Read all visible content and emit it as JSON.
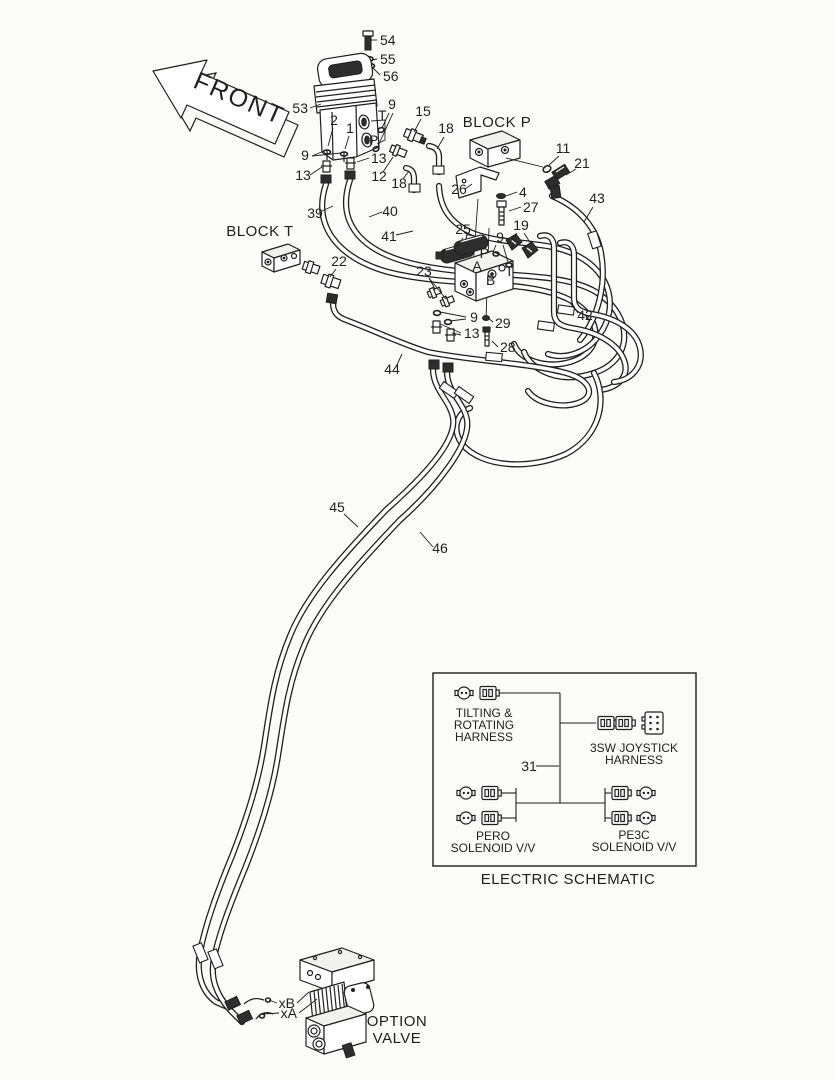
{
  "colors": {
    "ink": "#1f1f1f",
    "background": "#fbfbf9",
    "dark_fill": "#2e2e2e"
  },
  "front_arrow": {
    "label": "FRONT"
  },
  "labels": {
    "block_p": "BLOCK P",
    "block_t": "BLOCK T"
  },
  "option_valve": {
    "title_line1": "OPTION",
    "title_line2": "VALVE"
  },
  "electric_schematic": {
    "title": "ELECTRIC SCHEMATIC",
    "tilting_harness": [
      "TILTING &",
      "ROTATING",
      "HARNESS"
    ],
    "joystick_harness": [
      "3SW JOYSTICK",
      "HARNESS"
    ],
    "pero": [
      "PERO",
      "SOLENOID V/V"
    ],
    "pe3c": [
      "PE3C",
      "SOLENOID V/V"
    ],
    "connectors": [
      {
        "type": "round",
        "x": 464,
        "y": 693
      },
      {
        "type": "plug",
        "x": 488,
        "y": 693
      },
      {
        "type": "plug",
        "x": 606,
        "y": 723
      },
      {
        "type": "plug",
        "x": 624,
        "y": 723
      },
      {
        "type": "plug6",
        "x": 654,
        "y": 723
      },
      {
        "type": "round",
        "x": 466,
        "y": 793
      },
      {
        "type": "plug",
        "x": 490,
        "y": 793
      },
      {
        "type": "round",
        "x": 466,
        "y": 818
      },
      {
        "type": "plug",
        "x": 490,
        "y": 818
      },
      {
        "type": "plug",
        "x": 620,
        "y": 793
      },
      {
        "type": "round",
        "x": 646,
        "y": 793
      },
      {
        "type": "plug",
        "x": 620,
        "y": 818
      },
      {
        "type": "round",
        "x": 646,
        "y": 818
      }
    ]
  },
  "callouts": [
    {
      "t": "54",
      "x": 380,
      "y": 45,
      "an": "start",
      "leads": [
        [
          377,
          40,
          371,
          40
        ]
      ]
    },
    {
      "t": "55",
      "x": 380,
      "y": 64,
      "an": "start",
      "leads": [
        [
          377,
          59,
          372,
          60
        ]
      ]
    },
    {
      "t": "56",
      "x": 383,
      "y": 81,
      "an": "start",
      "leads": [
        [
          380,
          75,
          372,
          67
        ]
      ]
    },
    {
      "t": "53",
      "x": 308,
      "y": 113,
      "an": "end",
      "leads": [
        [
          310,
          108,
          321,
          104
        ]
      ]
    },
    {
      "t": "9",
      "x": 392,
      "y": 109,
      "leads": [
        [
          389,
          113,
          382,
          128
        ],
        [
          393,
          113,
          378,
          146
        ]
      ]
    },
    {
      "t": "15",
      "x": 423,
      "y": 116,
      "leads": [
        [
          421,
          119,
          414,
          132
        ]
      ]
    },
    {
      "t": "18",
      "x": 446,
      "y": 133,
      "leads": [
        [
          444,
          137,
          437,
          149
        ]
      ]
    },
    {
      "t": "2",
      "x": 334,
      "y": 125,
      "fs": 12,
      "leads": [
        [
          333,
          128,
          328,
          146
        ]
      ]
    },
    {
      "t": "1",
      "x": 350,
      "y": 133,
      "fs": 12,
      "leads": [
        [
          349,
          136,
          345,
          149
        ]
      ]
    },
    {
      "t": "T",
      "x": 378,
      "y": 120,
      "fs": 11,
      "an": "start"
    },
    {
      "t": "P",
      "x": 369,
      "y": 145,
      "fs": 11,
      "an": "start"
    },
    {
      "t": "9",
      "x": 305,
      "y": 160,
      "leads": [
        [
          312,
          156,
          324,
          151
        ],
        [
          312,
          156,
          341,
          153
        ]
      ]
    },
    {
      "t": "13",
      "x": 371,
      "y": 163,
      "an": "start",
      "leads": [
        [
          369,
          158,
          357,
          162
        ]
      ]
    },
    {
      "t": "13",
      "x": 303,
      "y": 180,
      "leads": [
        [
          310,
          175,
          322,
          167
        ]
      ]
    },
    {
      "t": "12",
      "x": 379,
      "y": 181,
      "leads": [
        [
          383,
          172,
          393,
          157
        ]
      ]
    },
    {
      "t": "18",
      "x": 399,
      "y": 188,
      "leads": [
        [
          403,
          179,
          409,
          171
        ]
      ]
    },
    {
      "t": "39",
      "x": 315,
      "y": 218,
      "leads": [
        [
          322,
          211,
          333,
          206
        ]
      ]
    },
    {
      "t": "40",
      "x": 390,
      "y": 216,
      "leads": [
        [
          382,
          212,
          369,
          217
        ]
      ]
    },
    {
      "t": "41",
      "x": 389,
      "y": 241,
      "leads": [
        [
          396,
          235,
          413,
          231
        ]
      ]
    },
    {
      "t": "11",
      "x": 563,
      "y": 153,
      "leads": [
        [
          559,
          156,
          549,
          165
        ]
      ]
    },
    {
      "t": "21",
      "x": 582,
      "y": 168,
      "leads": [
        [
          576,
          169,
          566,
          175
        ]
      ]
    },
    {
      "t": "26",
      "x": 459,
      "y": 194,
      "leads": [
        [
          465,
          189,
          472,
          184
        ]
      ]
    },
    {
      "t": "4",
      "x": 519,
      "y": 197,
      "an": "start",
      "leads": [
        [
          517,
          192,
          506,
          196
        ]
      ]
    },
    {
      "t": "27",
      "x": 523,
      "y": 212,
      "an": "start",
      "leads": [
        [
          521,
          207,
          509,
          211
        ]
      ]
    },
    {
      "t": "43",
      "x": 597,
      "y": 203,
      "leads": [
        [
          593,
          207,
          584,
          222
        ]
      ]
    },
    {
      "t": "25",
      "x": 463,
      "y": 234,
      "leads": [
        [
          463,
          238,
          457,
          247
        ]
      ]
    },
    {
      "t": "19",
      "x": 521,
      "y": 230,
      "leads": [
        [
          517,
          233,
          510,
          242
        ],
        [
          524,
          233,
          531,
          244
        ]
      ]
    },
    {
      "t": "9",
      "x": 500,
      "y": 242,
      "leads": [
        [
          496,
          245,
          493,
          252
        ],
        [
          503,
          245,
          508,
          262
        ]
      ]
    },
    {
      "t": "22",
      "x": 339,
      "y": 266,
      "leads": [
        [
          336,
          269,
          330,
          277
        ]
      ]
    },
    {
      "t": "23",
      "x": 424,
      "y": 276,
      "leads": [
        [
          429,
          278,
          435,
          289
        ],
        [
          429,
          278,
          446,
          299
        ]
      ]
    },
    {
      "t": "P",
      "x": 489,
      "y": 258,
      "fs": 11,
      "an": "end"
    },
    {
      "t": "T",
      "x": 505,
      "y": 276,
      "fs": 11,
      "an": "start"
    },
    {
      "t": "A",
      "x": 477,
      "y": 271,
      "fs": 11
    },
    {
      "t": "B",
      "x": 486,
      "y": 285,
      "fs": 11,
      "an": "start"
    },
    {
      "t": "9",
      "x": 474,
      "y": 322,
      "leads": [
        [
          466,
          317,
          440,
          312
        ],
        [
          466,
          319,
          450,
          321
        ]
      ]
    },
    {
      "t": "29",
      "x": 495,
      "y": 328,
      "an": "start",
      "leads": [
        [
          493,
          322,
          488,
          318
        ]
      ]
    },
    {
      "t": "13",
      "x": 464,
      "y": 338,
      "an": "start",
      "leads": [
        [
          461,
          333,
          440,
          324
        ],
        [
          461,
          335,
          452,
          333
        ]
      ]
    },
    {
      "t": "28",
      "x": 500,
      "y": 352,
      "an": "start",
      "leads": [
        [
          498,
          347,
          492,
          341
        ]
      ]
    },
    {
      "t": "42",
      "x": 585,
      "y": 320,
      "leads": [
        [
          578,
          313,
          570,
          303
        ]
      ]
    },
    {
      "t": "44",
      "x": 392,
      "y": 374,
      "leads": [
        [
          396,
          367,
          402,
          354
        ]
      ]
    },
    {
      "t": "45",
      "x": 337,
      "y": 512,
      "leads": [
        [
          344,
          514,
          358,
          527
        ]
      ]
    },
    {
      "t": "46",
      "x": 440,
      "y": 553,
      "leads": [
        [
          433,
          547,
          420,
          532
        ]
      ]
    },
    {
      "t": "31",
      "x": 529,
      "y": 771,
      "leads": [
        [
          536,
          766,
          559,
          766
        ]
      ]
    },
    {
      "t": "xB",
      "x": 295,
      "y": 1008,
      "fs": 12,
      "an": "end",
      "leads": [
        [
          297,
          1003,
          309,
          992
        ],
        [
          277,
          1003,
          269,
          1000
        ]
      ]
    },
    {
      "t": "xA",
      "x": 297,
      "y": 1018,
      "fs": 12,
      "an": "end",
      "leads": [
        [
          299,
          1013,
          317,
          999
        ],
        [
          279,
          1013,
          263,
          1014
        ]
      ]
    }
  ]
}
